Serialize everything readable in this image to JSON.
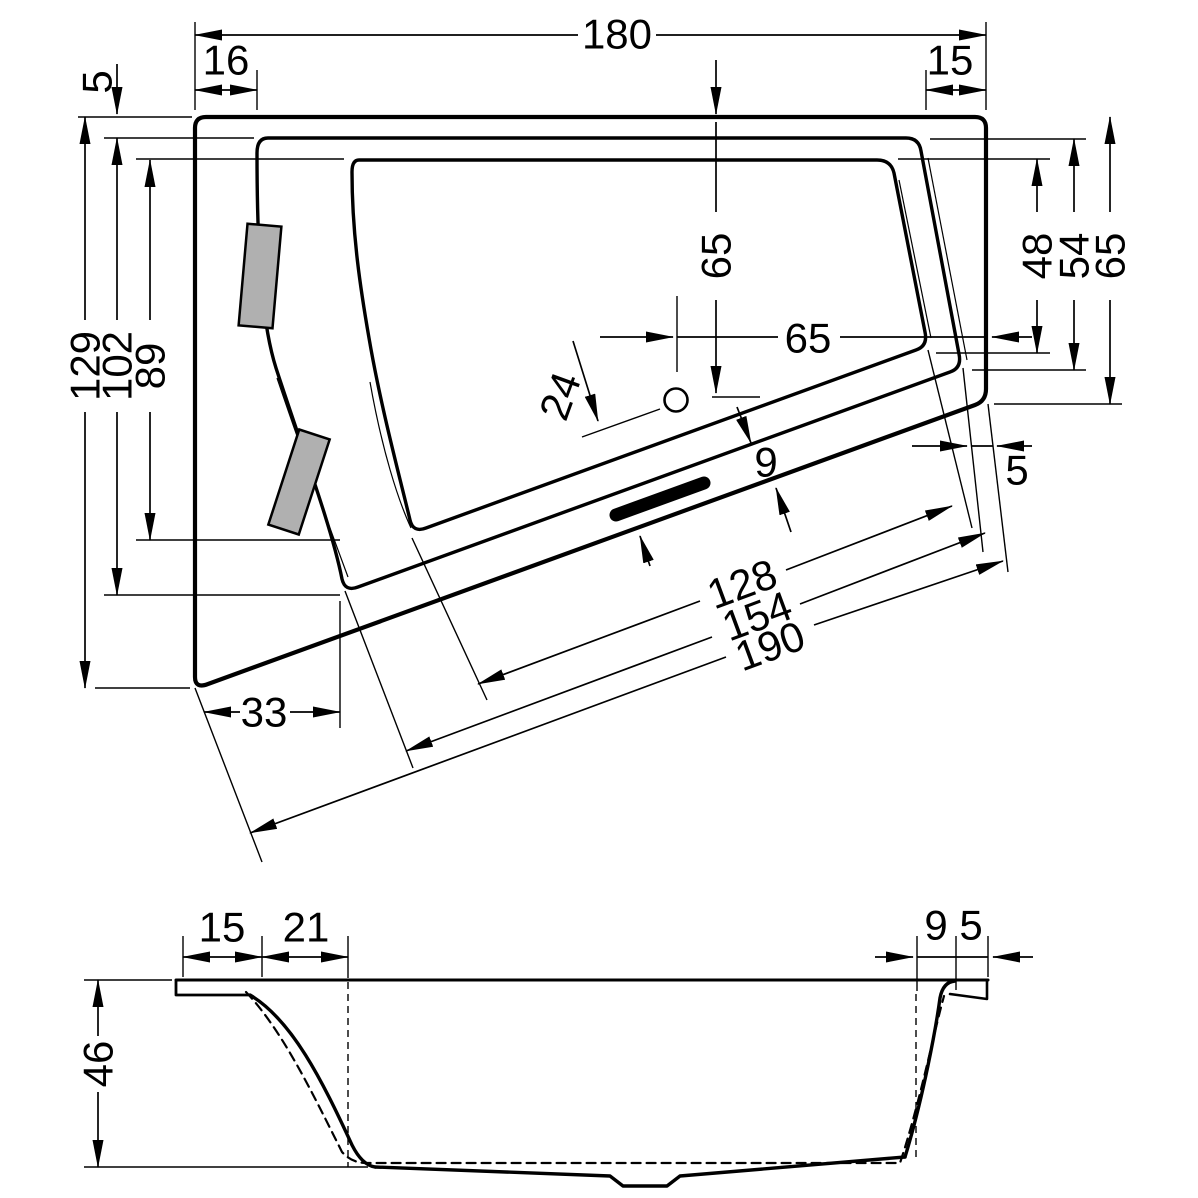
{
  "drawing": {
    "plan": {
      "width_overall": "180",
      "rim_offset_top_left": "16",
      "rim_offset_top_right": "15",
      "rim_gap_top_left": "5",
      "length_overall": "129",
      "length_rim_inner": "102",
      "length_basin": "89",
      "drain_from_top_edge": "65",
      "drain_from_right_edge": "65",
      "drain_to_front_edge": "24",
      "right_basin_depth": "48",
      "right_rim_depth": "54",
      "right_overall_depth": "65",
      "front_rim_width": "9",
      "front_right_rim_width": "5",
      "bottom_left_offset": "33",
      "diagonal_basin": "128",
      "diagonal_rim": "154",
      "diagonal_overall": "190"
    },
    "section": {
      "rim_width_left": "15",
      "slope_run_left": "21",
      "depth": "46",
      "rim_width_right_inner": "9",
      "rim_width_right_outer": "5"
    }
  }
}
